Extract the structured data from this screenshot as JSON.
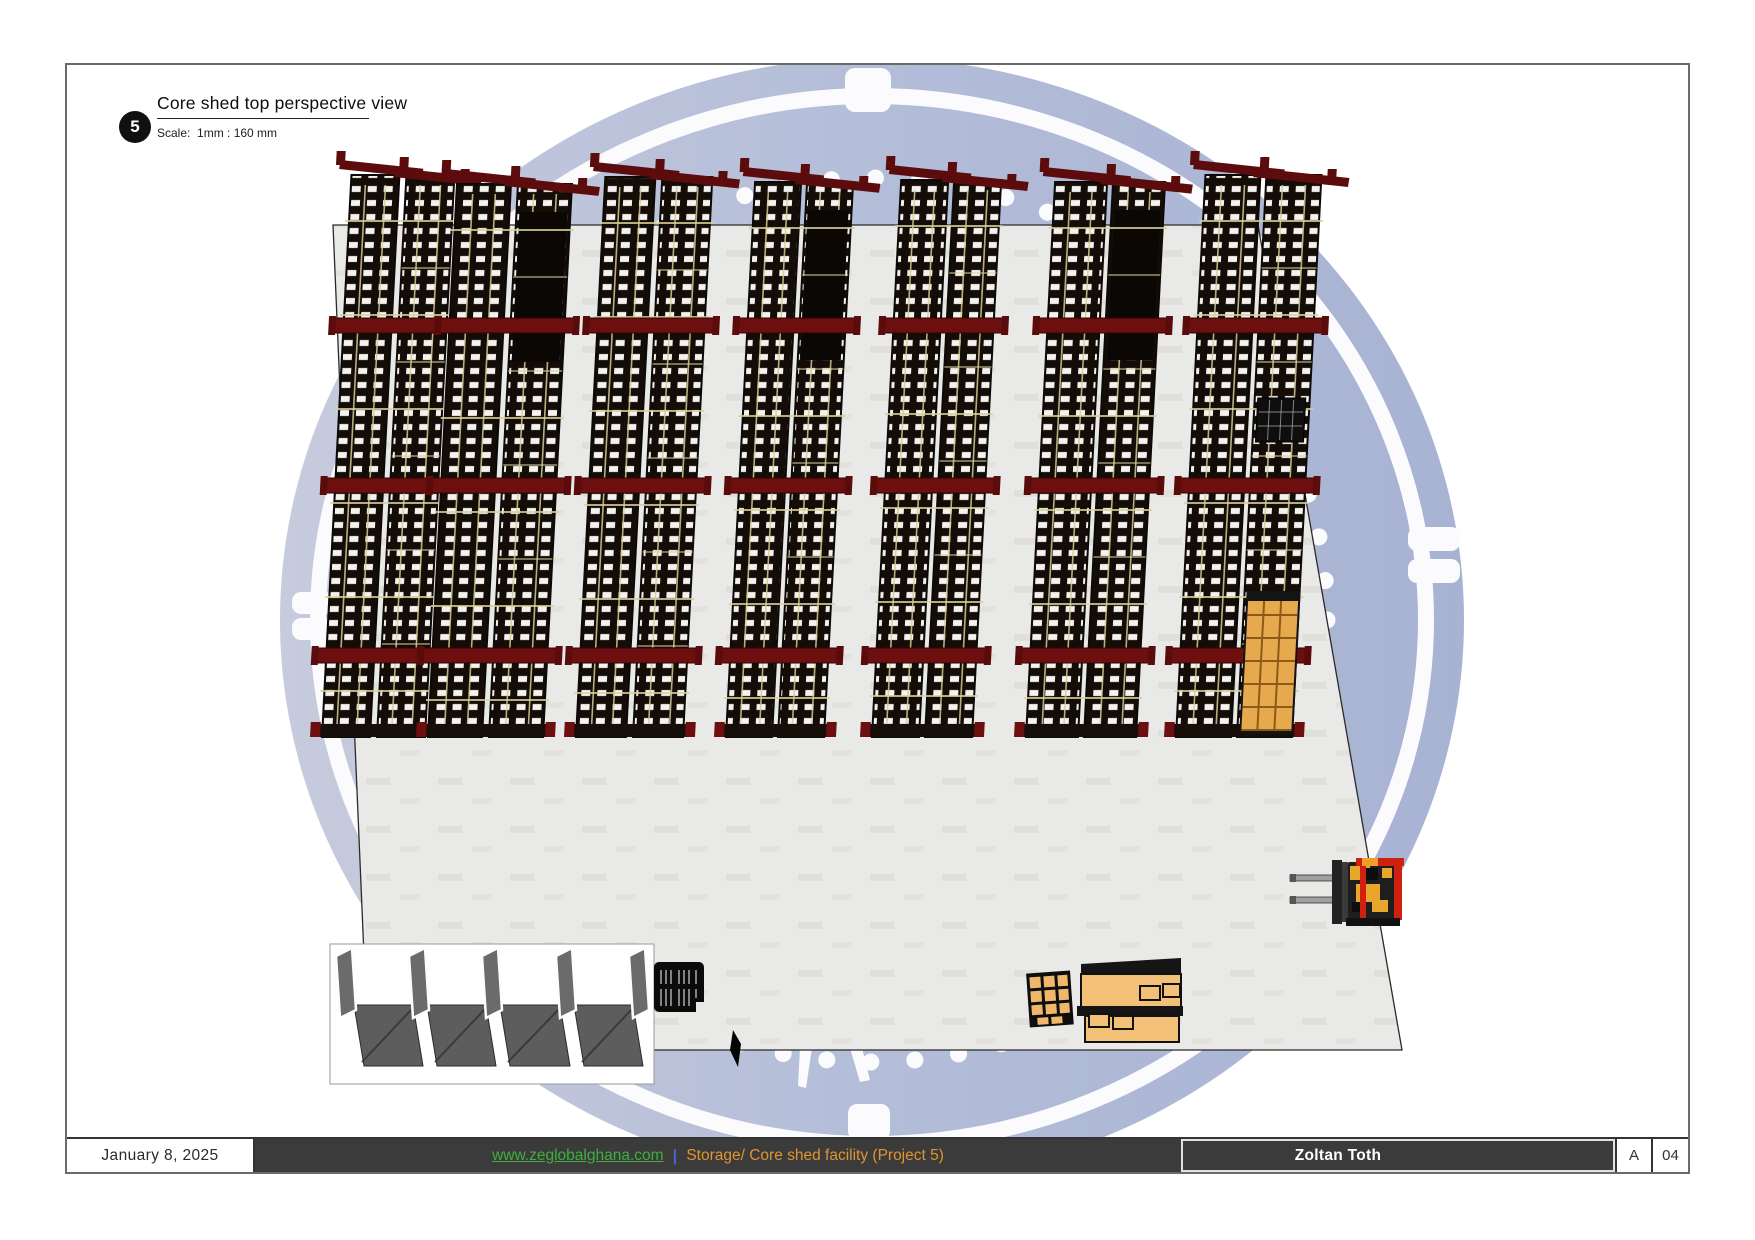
{
  "title_block": {
    "number": "5",
    "title": "Core shed top perspective view",
    "scale_label": "Scale:  1mm : 160 mm"
  },
  "footer": {
    "date": "January 8, 2025",
    "website": "www.zeglobalghana.com",
    "separator": "|",
    "project": "Storage/ Core shed facility (Project 5)",
    "author": "Zoltan Toth",
    "revision": "A",
    "sheet_number": "04"
  },
  "colors": {
    "footer_bar": "#3b3b3b",
    "link_green": "#3fae3f",
    "project_orange": "#e0952f",
    "separator_blue": "#4a5fd0",
    "watermark_blue": "#aeb8d5",
    "rack_red": "#6e0f0f",
    "rack_tan": "#d9cf99",
    "floor_gray": "#e9e9e7"
  },
  "scene": {
    "rack_rows": 7,
    "objects": [
      "watermark-compass-logo",
      "floor-slab",
      "storage-rack-rows",
      "storage-bays",
      "pallet-stack",
      "floor-mark",
      "worktables",
      "forklift",
      "crate-stack"
    ]
  }
}
